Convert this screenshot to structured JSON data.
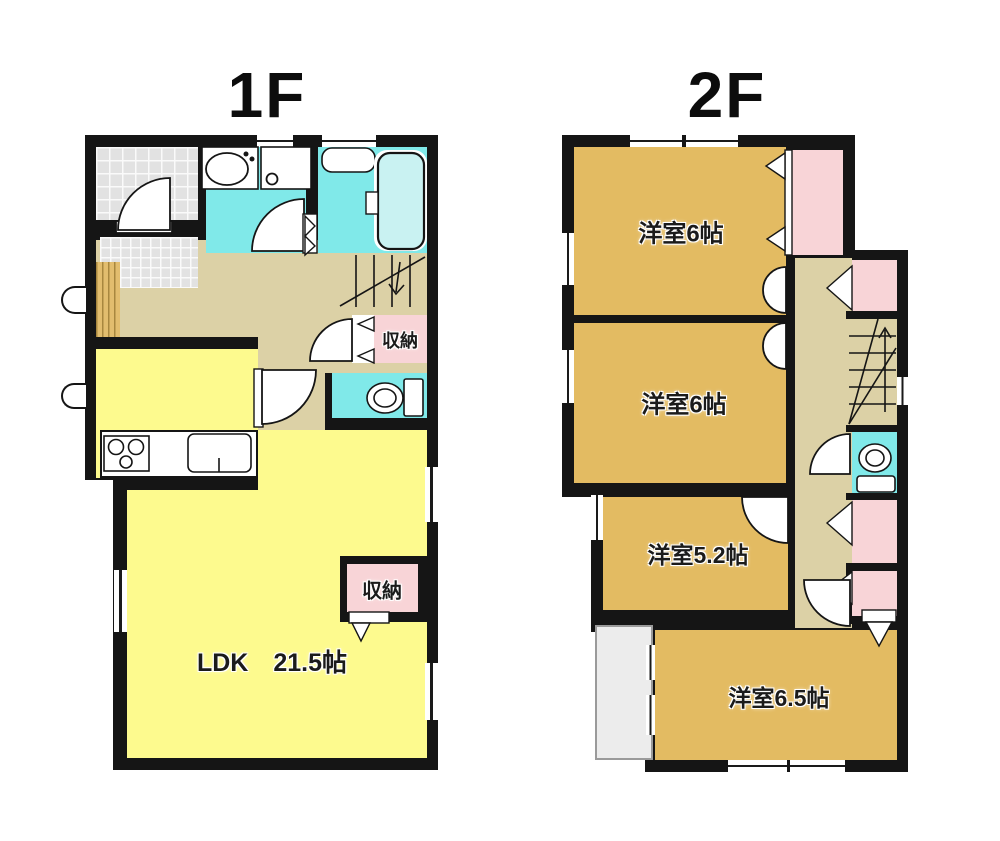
{
  "floors": [
    {
      "name": "1F",
      "rooms": [
        {
          "id": "ldk",
          "label": "LDK　21.5帖"
        },
        {
          "id": "hall-storage",
          "label": "収納"
        },
        {
          "id": "ldk-storage",
          "label": "収納"
        }
      ],
      "fixtures": [
        "entrance-tile",
        "wood-deck-step",
        "vanity-sink",
        "washing-machine-pan",
        "bathtub",
        "toilet",
        "kitchen-stove",
        "kitchen-sink",
        "staircase-down"
      ]
    },
    {
      "name": "2F",
      "rooms": [
        {
          "id": "bedroom-north",
          "label": "洋室6帖"
        },
        {
          "id": "bedroom-middle",
          "label": "洋室6帖"
        },
        {
          "id": "bedroom-5-2",
          "label": "洋室5.2帖"
        },
        {
          "id": "bedroom-6-5",
          "label": "洋室6.5帖"
        }
      ],
      "fixtures": [
        "closet",
        "closet",
        "closet",
        "closet",
        "toilet",
        "staircase-up",
        "roof-area"
      ]
    }
  ],
  "colors": {
    "ldk_yellow": "#fdfa8e",
    "hall_tan": "#dcd1a6",
    "room_ochre": "#e3bb62",
    "wet_area_cyan": "#80e9e9",
    "closet_pink": "#f8d4d7",
    "entrance_tile_gray": "#e2e2e2",
    "roof_gray": "#ececec",
    "wall_black": "#151515"
  }
}
